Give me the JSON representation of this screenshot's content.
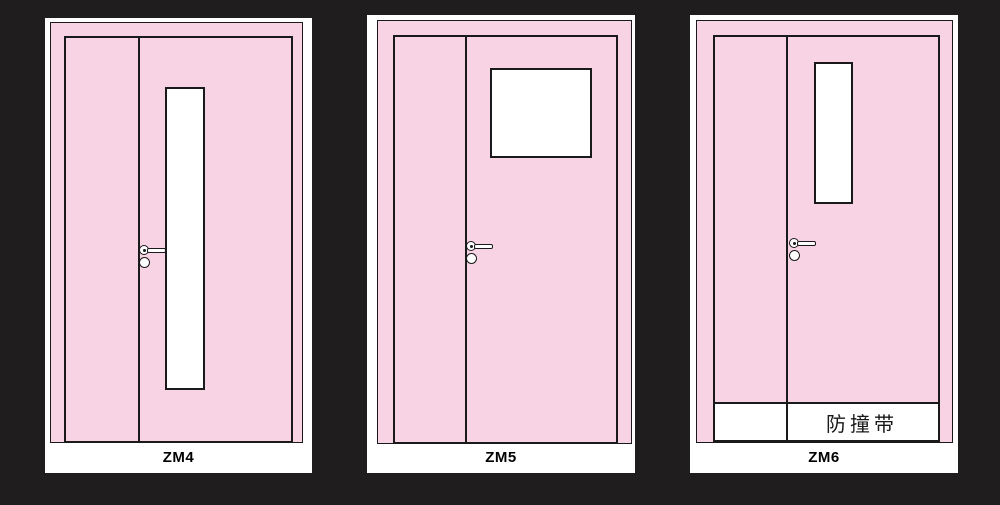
{
  "colors": {
    "background": "#201d1e",
    "door_pink": "#f8d3e3",
    "outline": "#1a1a1a",
    "mat_white": "#ffffff"
  },
  "panels": [
    {
      "id": "zm4",
      "label": "ZM4",
      "window_type": "tall-narrow-vision-panel"
    },
    {
      "id": "zm5",
      "label": "ZM5",
      "window_type": "square-vision-panel"
    },
    {
      "id": "zm6",
      "label": "ZM6",
      "window_type": "short-narrow-vision-panel",
      "strip_label": "防撞带"
    }
  ]
}
